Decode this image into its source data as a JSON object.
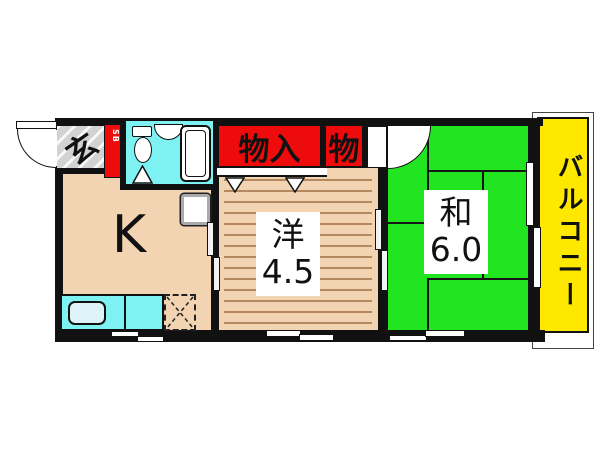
{
  "floorplan": {
    "entrance": {
      "label": "玄"
    },
    "shoe_box": {
      "label": "SB"
    },
    "kitchen": {
      "label": "K"
    },
    "western_room": {
      "name": "洋",
      "size": "4.5"
    },
    "japanese_room": {
      "name": "和",
      "size": "6.0"
    },
    "closet_large": {
      "label": "物入"
    },
    "closet_small": {
      "label": "物"
    },
    "balcony": {
      "label": "バルコニー"
    },
    "colors": {
      "wall": "#111111",
      "floor_beige": "#f2d4b2",
      "flooring_line": "#b5895f",
      "tatami_green": "#22e522",
      "closet_red": "#ee0b0b",
      "balcony_yellow": "#ffe800",
      "bath_cyan": "#7ef2f2",
      "entrance_gray": "#d2d2d2"
    }
  }
}
